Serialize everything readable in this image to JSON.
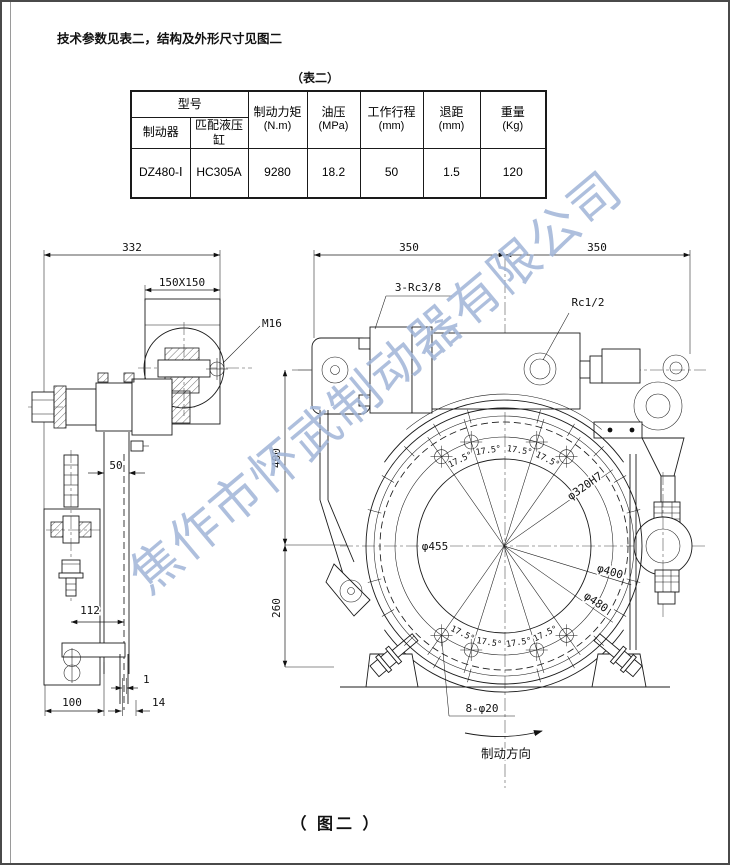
{
  "page": {
    "intro_text": "技术参数见表二，结构及外形尺寸见图二",
    "table_caption": "（表二）",
    "figure_caption": "（ 图二 ）",
    "watermark": "焦作市怀武制动器有限公司"
  },
  "table": {
    "header": {
      "model_group": "型号",
      "brake": "制动器",
      "match_cylinder": "匹配液压缸",
      "torque": "制动力矩",
      "torque_unit": "(N.m)",
      "oil_pressure": "油压",
      "oil_pressure_unit": "(MPa)",
      "stroke": "工作行程",
      "stroke_unit": "(mm)",
      "retract": "退距",
      "retract_unit": "(mm)",
      "weight": "重量",
      "weight_unit": "(Kg)"
    },
    "row": {
      "brake_model": "DZ480-Ⅰ",
      "cylinder_model": "HC305A",
      "torque": "9280",
      "oil_pressure": "18.2",
      "stroke": "50",
      "retract": "1.5",
      "weight": "120"
    }
  },
  "drawing": {
    "left_view": {
      "dim_width": "332",
      "dim_square": "150X150",
      "bolt_label": "M16",
      "dim_arm": "50",
      "dim_112": "112",
      "dim_100": "100",
      "dim_gap": "1",
      "dim_pad": "14"
    },
    "front_view": {
      "dim_350_left": "350",
      "dim_350_right": "350",
      "ports_label": "3-Rc3/8",
      "port_label": "Rc1/2",
      "dim_400": "400",
      "dim_260": "260",
      "dia_455": "φ455",
      "dia_320": "φ320H7",
      "dia_400": "φ400",
      "dia_480": "φ480",
      "holes_label": "8-φ20",
      "angle": "17.5°",
      "direction_label": "制动方向"
    }
  }
}
